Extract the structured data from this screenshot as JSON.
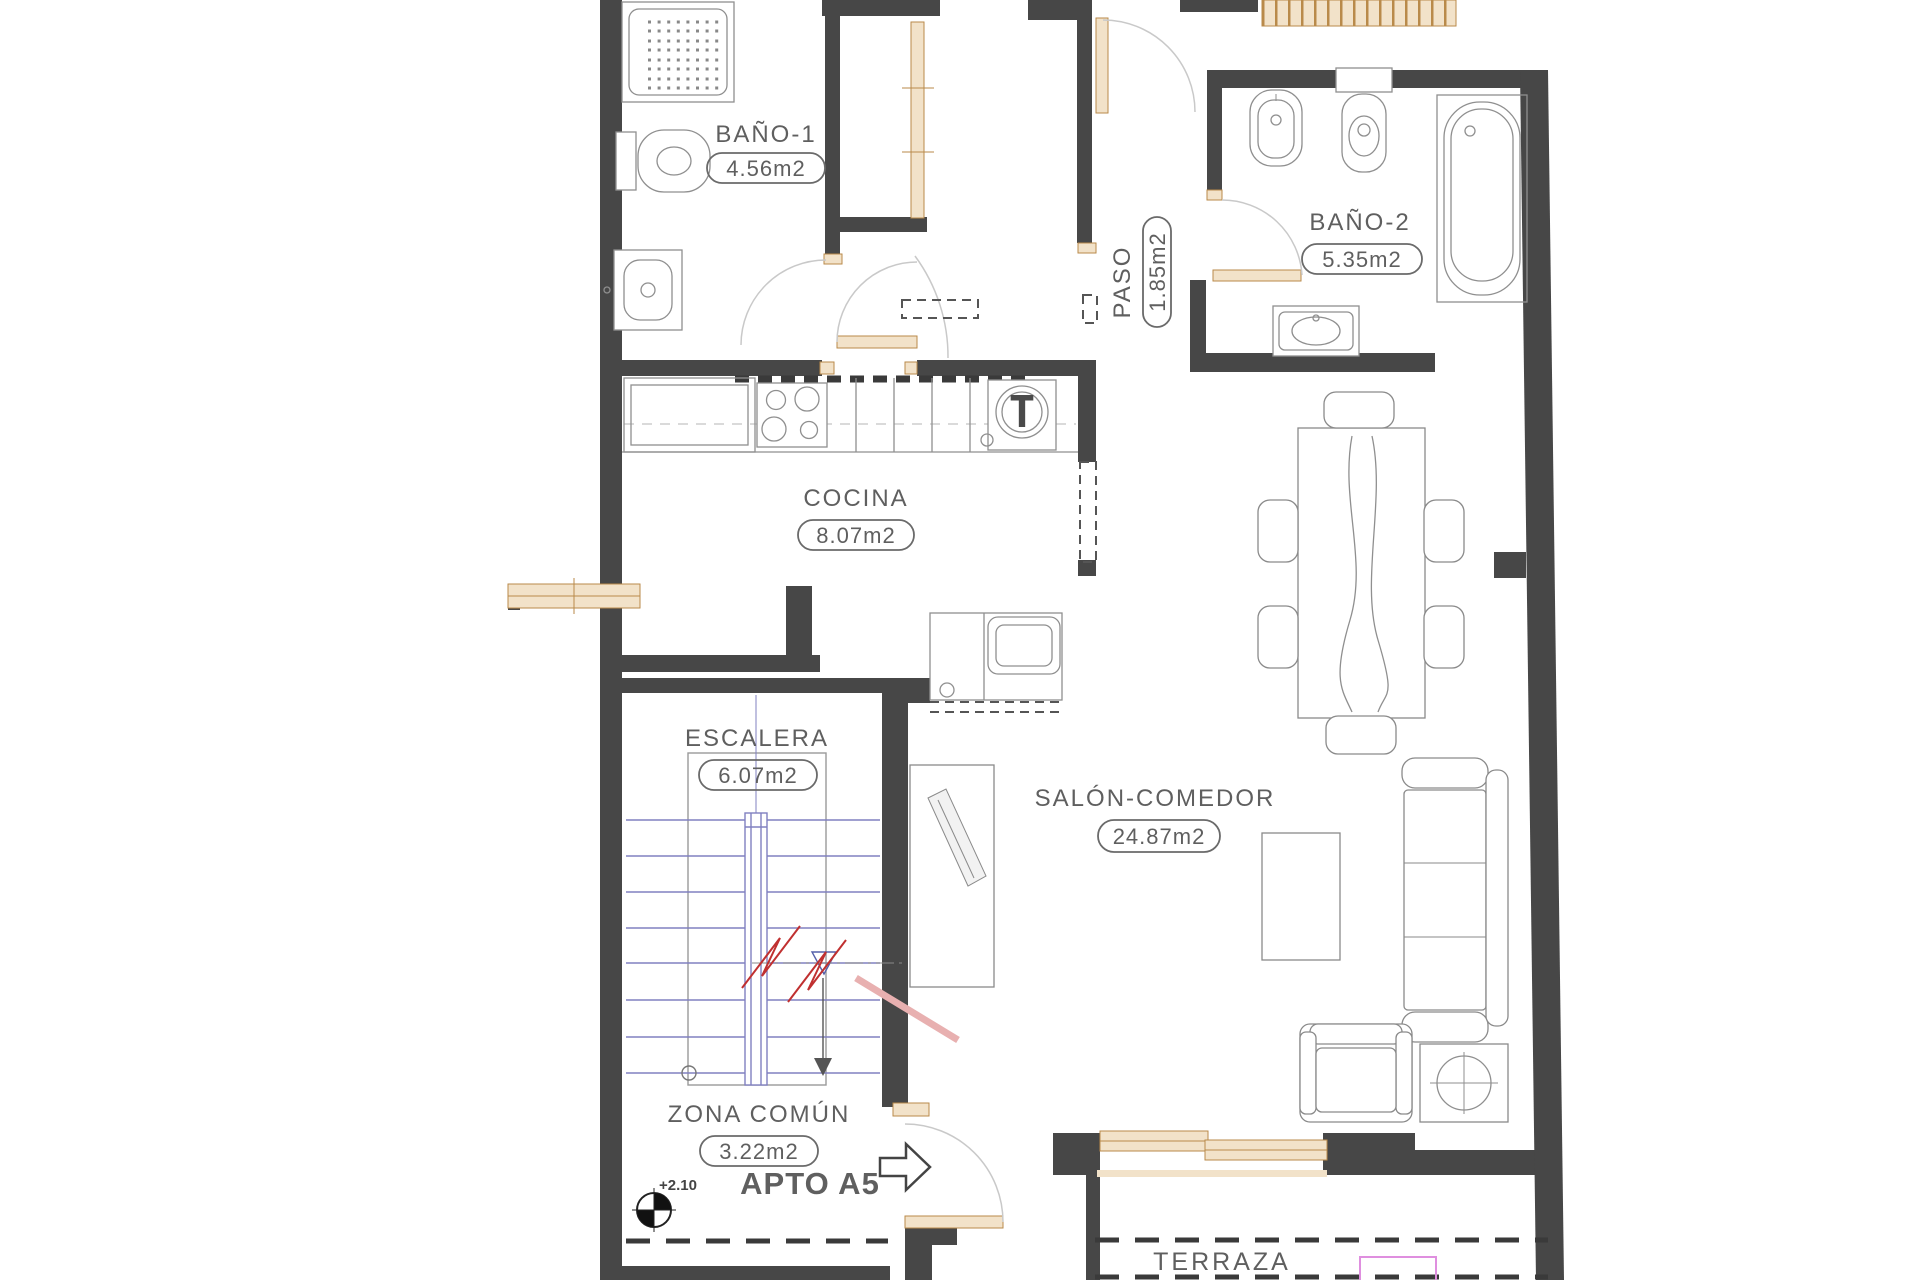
{
  "plan": {
    "rooms": {
      "bano1": {
        "name": "BAÑO-1",
        "area": "4.56m2"
      },
      "bano2": {
        "name": "BAÑO-2",
        "area": "5.35m2"
      },
      "paso": {
        "name": "PASO",
        "area": "1.85m2"
      },
      "cocina": {
        "name": "COCINA",
        "area": "8.07m2"
      },
      "escalera": {
        "name": "ESCALERA",
        "area": "6.07m2"
      },
      "salon": {
        "name": "SALÓN-COMEDOR",
        "area": "24.87m2"
      },
      "zona_comun": {
        "name": "ZONA COMÚN",
        "area": "3.22m2"
      },
      "terraza": {
        "name": "TERRAZA"
      }
    },
    "annotations": {
      "apartment": "APTO A5",
      "level": "+2.10",
      "water_heater": "T"
    },
    "colors": {
      "wall": "#474747",
      "wood": "#f2e2c9",
      "wood_border": "#b98a4a",
      "text": "#5f5f5f",
      "apartment_green": "#5cb832",
      "stairs_blue": "#8080c0",
      "break_red": "#c03030",
      "highlight_pink": "#df8fdf"
    }
  }
}
